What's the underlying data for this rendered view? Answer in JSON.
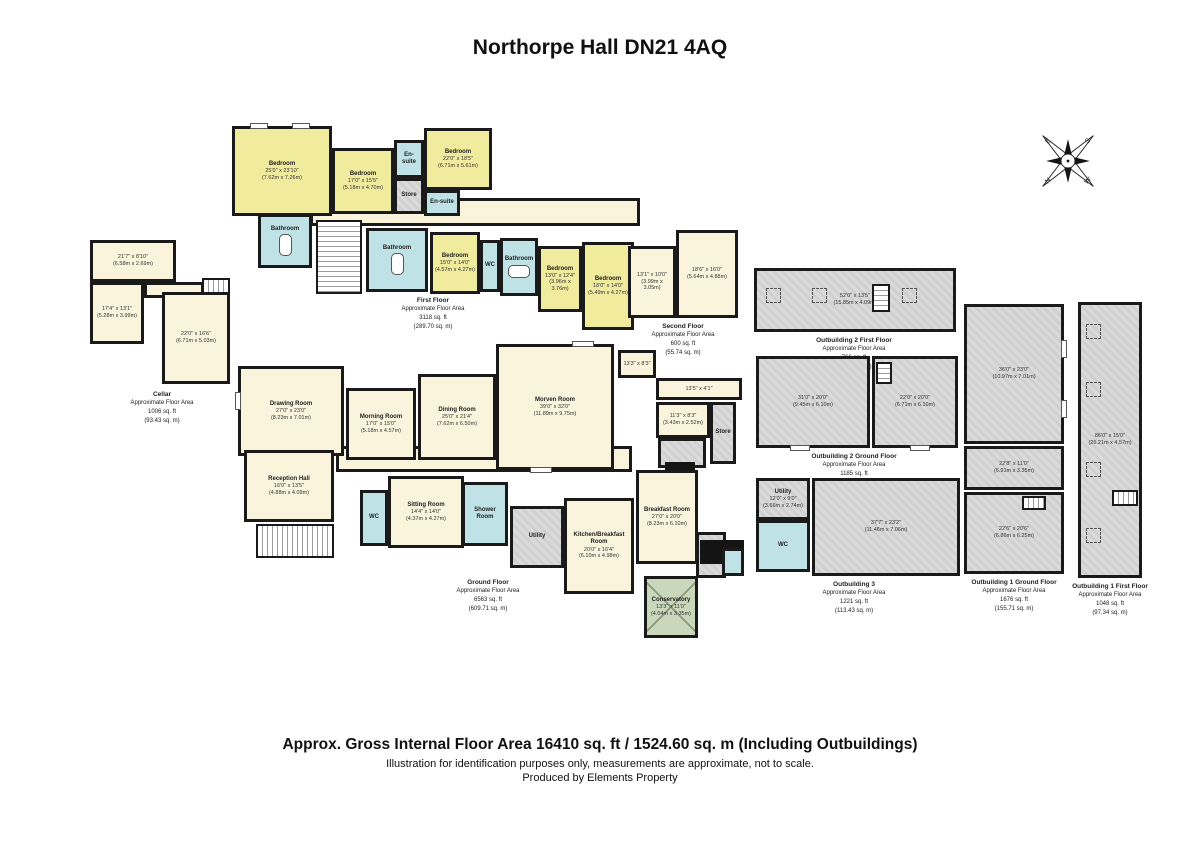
{
  "title": "Northorpe Hall DN21 4AQ",
  "compass": {
    "n": "N",
    "e": "E",
    "s": "S",
    "w": "W"
  },
  "floors": {
    "first": {
      "name": "First Floor",
      "approx": "Approximate Floor Area",
      "ft": "3118 sq. ft",
      "m": "(289.70 sq. m)"
    },
    "second": {
      "name": "Second Floor",
      "approx": "Approximate Floor Area",
      "ft": "600 sq. ft",
      "m": "(55.74 sq. m)"
    },
    "cellar": {
      "name": "Cellar",
      "approx": "Approximate Floor Area",
      "ft": "1006 sq. ft",
      "m": "(93.43 sq. m)"
    },
    "ground": {
      "name": "Ground Floor",
      "approx": "Approximate Floor Area",
      "ft": "6563 sq. ft",
      "m": "(609.71 sq. m)"
    },
    "ob2ff": {
      "name": "Outbuilding 2 First Floor",
      "approx": "Approximate Floor Area",
      "ft": "766 sq. ft",
      "m": "(71.17 sq. m)"
    },
    "ob2gf": {
      "name": "Outbuilding 2 Ground Floor",
      "approx": "Approximate Floor Area",
      "ft": "1185 sq. ft",
      "m": "(110.09 sq. m)"
    },
    "ob3": {
      "name": "Outbuilding 3",
      "approx": "Approximate Floor Area",
      "ft": "1221 sq. ft",
      "m": "(113.43 sq. m)"
    },
    "ob1gf": {
      "name": "Outbuilding 1 Ground Floor",
      "approx": "Approximate Floor Area",
      "ft": "1676 sq. ft",
      "m": "(155.71 sq. m)"
    },
    "ob1ff": {
      "name": "Outbuilding 1 First Floor",
      "approx": "Approximate Floor Area",
      "ft": "1048 sq. ft",
      "m": "(97.34 sq. m)"
    }
  },
  "rooms": {
    "ffb1": {
      "n": "Bedroom",
      "d": "25'0\" x 23'10\"",
      "m": "(7.62m x 7.26m)"
    },
    "ffb2": {
      "n": "Bedroom",
      "d": "17'0\" x 15'5\"",
      "m": "(5.18m x 4.70m)"
    },
    "ffes1": {
      "n": "En-suite"
    },
    "ffstore": {
      "n": "Store"
    },
    "ffb3": {
      "n": "Bedroom",
      "d": "22'0\" x 18'5\"",
      "m": "(6.71m x 5.61m)"
    },
    "ffes2": {
      "n": "En-suite"
    },
    "ffba1": {
      "n": "Bathroom"
    },
    "ffba2": {
      "n": "Bathroom"
    },
    "ffb4": {
      "n": "Bedroom",
      "d": "15'0\" x 14'0\"",
      "m": "(4.57m x 4.27m)"
    },
    "ffwc": {
      "n": "WC"
    },
    "ffba3": {
      "n": "Bathroom"
    },
    "ffb5": {
      "n": "Bedroom",
      "d": "13'0\" x 12'4\"",
      "m": "(3.96m x 3.76m)"
    },
    "ffb6": {
      "n": "Bedroom",
      "d": "18'0\" x 14'0\"",
      "m": "(5.49m x 4.27m)"
    },
    "sf1": {
      "d": "13'1\" x 10'0\"",
      "m": "(3.99m x 3.05m)"
    },
    "sf2": {
      "d": "18'6\" x 16'0\"",
      "m": "(5.64m x 4.88m)"
    },
    "cl1": {
      "d": "21'7\" x 8'10\"",
      "m": "(6.58m x 2.69m)"
    },
    "cl2": {
      "d": "17'4\" x 13'1\"",
      "m": "(5.28m x 3.99m)"
    },
    "cl3": {
      "d": "22'0\" x 16'6\"",
      "m": "(6.71m x 5.03m)"
    },
    "gdraw": {
      "n": "Drawing Room",
      "d": "27'0\" x 23'0\"",
      "m": "(8.23m x 7.01m)"
    },
    "gmorn": {
      "n": "Morning Room",
      "d": "17'0\" x 15'0\"",
      "m": "(5.18m x 4.57m)"
    },
    "gdin": {
      "n": "Dining Room",
      "d": "25'0\" x 21'4\"",
      "m": "(7.62m x 6.50m)"
    },
    "gmorv": {
      "n": "Morven Room",
      "d": "39'0\" x 32'0\"",
      "m": "(11.89m x 9.75m)"
    },
    "grec": {
      "n": "Reception Hall",
      "d": "16'0\" x 13'5\"",
      "m": "(4.88m x 4.09m)"
    },
    "ggal": {
      "n": "Picture Gallery"
    },
    "gsit": {
      "n": "Sitting Room",
      "d": "14'4\" x 14'0\"",
      "m": "(4.37m x 4.27m)"
    },
    "gwc": {
      "n": "WC"
    },
    "gshow": {
      "n": "Shower Room"
    },
    "gut": {
      "n": "Utility"
    },
    "gkit": {
      "n": "Kitchen/Breakfast Room",
      "d": "20'0\" x 16'4\"",
      "m": "(6.10m x 4.98m)"
    },
    "gbrk": {
      "n": "Breakfast Room",
      "d": "27'0\" x 20'0\"",
      "m": "(8.23m x 6.10m)"
    },
    "gcon": {
      "n": "Conservatory",
      "d": "13'3\" x 11'0\"",
      "m": "(4.04m x 3.35m)"
    },
    "gs1": {
      "d": "13'3\" x 8'3\"",
      "m": "(4.04m x 2.52m)"
    },
    "gs2": {
      "d": "13'5\" x 4'1\"",
      "m": "(4.09m x 1.25m)"
    },
    "gs3": {
      "d": "11'3\" x 8'3\"",
      "m": "(3.43m x 2.52m)"
    },
    "gstore": {
      "n": "Store"
    },
    "o2f": {
      "d": "52'0\" x 13'5\"",
      "m": "(15.85m x 4.09m)"
    },
    "o2g1": {
      "d": "31'0\" x 20'0\"",
      "m": "(9.45m x 6.10m)"
    },
    "o2g2": {
      "d": "22'0\" x 20'0\"",
      "m": "(6.71m x 6.10m)"
    },
    "o3ut": {
      "n": "Utility",
      "d": "12'0\" x 9'0\"",
      "m": "(3.66m x 2.74m)"
    },
    "o3wc": {
      "n": "WC"
    },
    "o3main": {
      "d": "37'7\" x 23'2\"",
      "m": "(11.46m x 7.06m)"
    },
    "o1g1": {
      "d": "36'0\" x 23'0\"",
      "m": "(10.97m x 7.01m)"
    },
    "o1g2": {
      "d": "22'8\" x 11'0\"",
      "m": "(6.91m x 3.35m)"
    },
    "o1g3": {
      "d": "22'6\" x 20'6\"",
      "m": "(6.86m x 6.25m)"
    },
    "o1f": {
      "d": "86'0\" x 15'0\"",
      "m": "(26.21m x 4.57m)"
    }
  },
  "footer": {
    "line1": "Approx. Gross Internal Floor Area 16410 sq. ft / 1524.60 sq. m (Including Outbuildings)",
    "line2": "Illustration for identification purposes only, measurements are approximate, not to scale.",
    "line3": "Produced by Elements Property"
  }
}
